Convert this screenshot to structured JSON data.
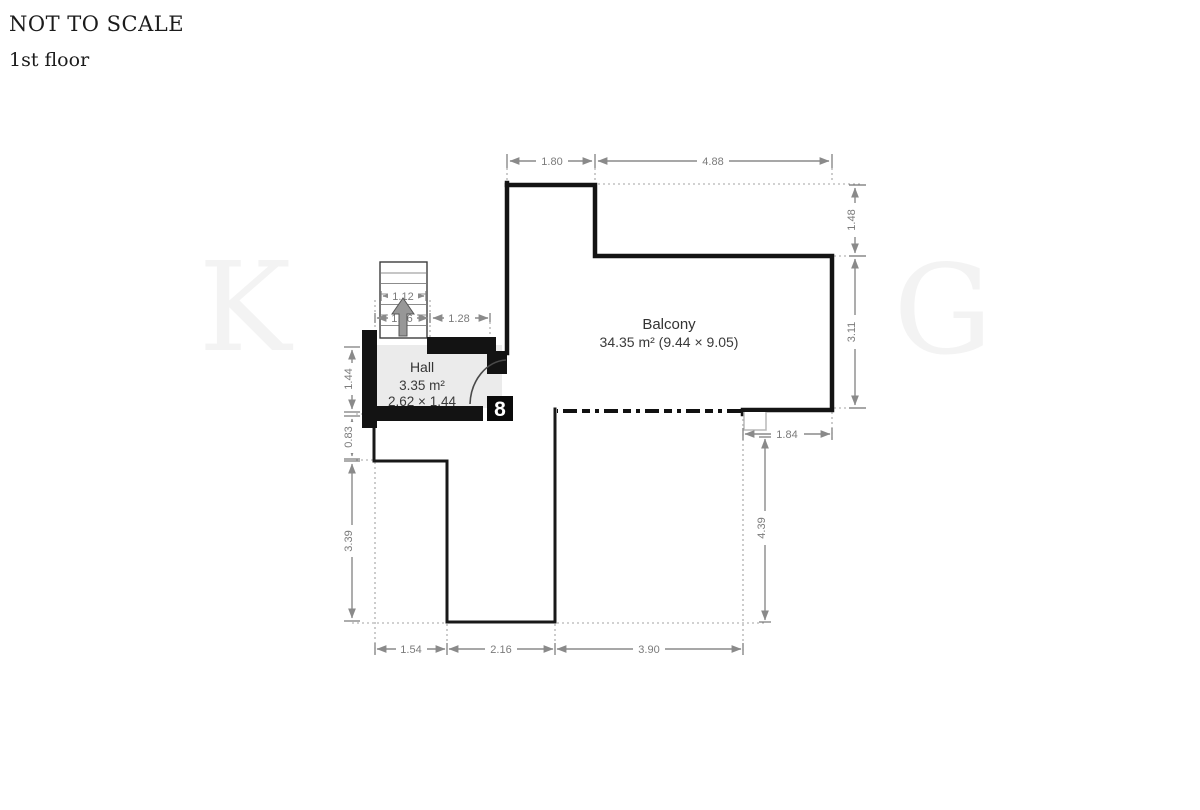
{
  "header": {
    "title": "NOT TO SCALE",
    "subtitle": "1st floor"
  },
  "rooms": {
    "balcony": {
      "name": "Balcony",
      "details": "34.35 m² (9.44 × 9.05)"
    },
    "hall": {
      "name": "Hall",
      "area": "3.35 m²",
      "size": "2.62 × 1.44"
    }
  },
  "dims": {
    "top_left": "1.80",
    "top_right": "4.88",
    "right_upper": "1.48",
    "right_mid": "3.11",
    "stairs_width": "1.12",
    "stairs_lower": "1.16",
    "stairs_gap": "1.28",
    "hall_height": "1.44",
    "left_small": "0.83",
    "left_lower": "3.39",
    "balcony_notch": "1.84",
    "lower_right_height": "4.39",
    "bottom_left": "1.54",
    "bottom_mid": "2.16",
    "bottom_right": "3.90"
  },
  "watermark": {
    "left_letter": "K",
    "right_letter": "G",
    "glyph": "8"
  },
  "icons": {
    "stairs_direction": "up-arrow"
  },
  "colors": {
    "wall": "#141414",
    "dimension": "#8a8a8a",
    "hall_floor": "#ebebeb",
    "label_text": "#3a3a3a",
    "watermark": "#f3f3f3"
  }
}
